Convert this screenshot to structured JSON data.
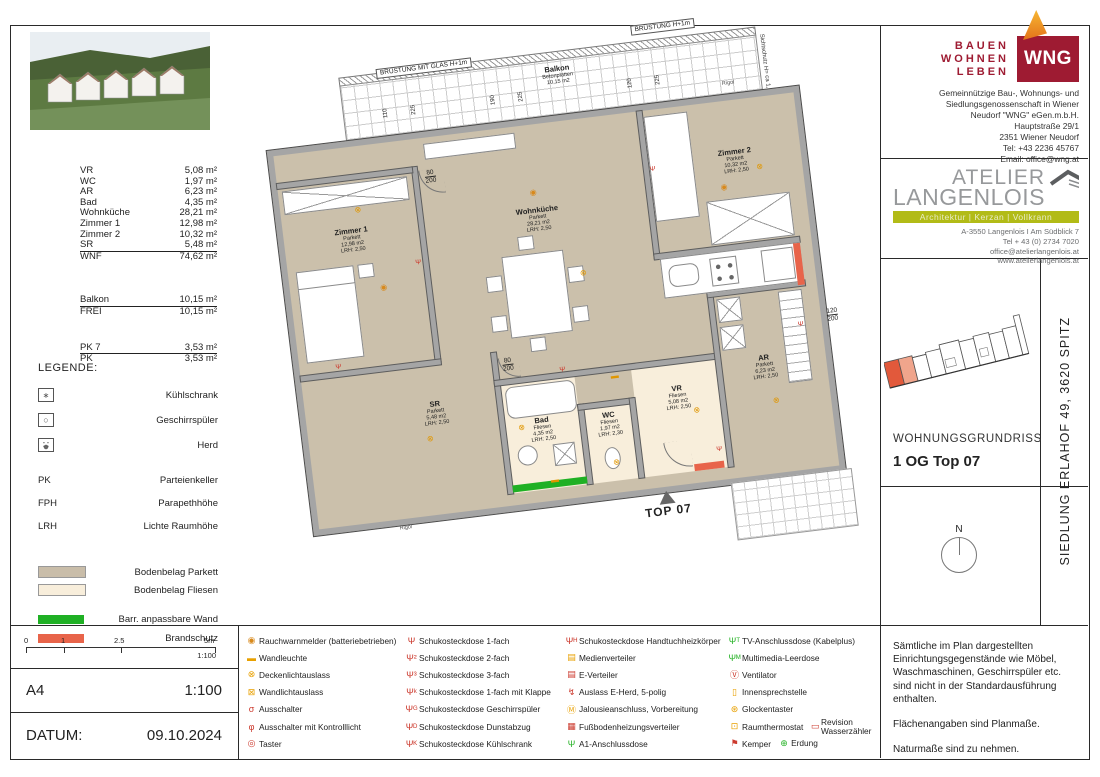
{
  "areas": {
    "rows": [
      {
        "label": "VR",
        "value": "5,08 m²",
        "cls": ""
      },
      {
        "label": "WC",
        "value": "1,97 m²",
        "cls": ""
      },
      {
        "label": "AR",
        "value": "6,23 m²",
        "cls": ""
      },
      {
        "label": "Bad",
        "value": "4,35 m²",
        "cls": ""
      },
      {
        "label": "Wohnküche",
        "value": "28,21 m²",
        "cls": ""
      },
      {
        "label": "Zimmer 1",
        "value": "12,98 m²",
        "cls": ""
      },
      {
        "label": "Zimmer 2",
        "value": "10,32 m²",
        "cls": ""
      },
      {
        "label": "SR",
        "value": "5,48 m²",
        "cls": "ruled"
      },
      {
        "label": "WNF",
        "value": "74,62 m²",
        "cls": ""
      },
      {
        "label": "Balkon",
        "value": "10,15 m²",
        "cls": "gap1 ruled"
      },
      {
        "label": "FREI",
        "value": "10,15 m²",
        "cls": ""
      },
      {
        "label": "PK 7",
        "value": "3,53 m²",
        "cls": "gap2 ruled"
      },
      {
        "label": "PK",
        "value": "3,53 m²",
        "cls": ""
      }
    ]
  },
  "legend": {
    "title": "LEGENDE:",
    "appliances": [
      {
        "icon": "fridge",
        "label": "Kühlschrank"
      },
      {
        "icon": "dishwasher",
        "label": "Geschirrspüler"
      },
      {
        "icon": "stove",
        "label": "Herd"
      }
    ],
    "abbrs": [
      {
        "abbr": "PK",
        "label": "Parteienkeller"
      },
      {
        "abbr": "FPH",
        "label": "Parapethhöhe"
      },
      {
        "abbr": "LRH",
        "label": "Lichte Raumhöhe"
      }
    ],
    "floors": [
      {
        "color": "#c9bda9",
        "label": "Bodenbelag Parkett"
      },
      {
        "color": "#f8eedb",
        "label": "Bodenbelag Fliesen"
      }
    ],
    "bars": [
      {
        "color": "#1fb024",
        "label": "Barr. anpassbare Wand"
      },
      {
        "color": "#e8644a",
        "label": "Brandschutz"
      }
    ]
  },
  "scalebar": {
    "ticks": [
      "0",
      "1",
      "2.5",
      "5m"
    ],
    "ratio": "1:100"
  },
  "format_row": {
    "format": "A4",
    "scale": "1:100"
  },
  "date_row": {
    "label": "DATUM:",
    "value": "09.10.2024"
  },
  "symbol_legend": {
    "col1": [
      {
        "g": "◉",
        "c": "#d8891c",
        "label": "Rauchwarnmelder (batteriebetrieben)"
      },
      {
        "g": "▬",
        "c": "#e8a000",
        "label": "Wandleuchte"
      },
      {
        "g": "⊗",
        "c": "#e8a000",
        "label": "Deckenlichtauslass"
      },
      {
        "g": "⊠",
        "c": "#e8a000",
        "label": "Wandlichtauslass"
      },
      {
        "g": "σ",
        "c": "#cc3a2e",
        "label": "Ausschalter"
      },
      {
        "g": "φ",
        "c": "#cc3a2e",
        "label": "Ausschalter mit Kontrolllicht"
      },
      {
        "g": "◎",
        "c": "#cc3a2e",
        "label": "Taster"
      }
    ],
    "col2": [
      {
        "g": "Ψ",
        "c": "#cc3a2e",
        "label": "Schukosteckdose 1-fach"
      },
      {
        "g": "Ψ²",
        "c": "#cc3a2e",
        "label": "Schukosteckdose 2-fach"
      },
      {
        "g": "Ψ³",
        "c": "#cc3a2e",
        "label": "Schukosteckdose 3-fach"
      },
      {
        "g": "Ψᵏ",
        "c": "#cc3a2e",
        "label": "Schukosteckdose 1-fach mit Klappe"
      },
      {
        "g": "Ψᴳ",
        "c": "#cc3a2e",
        "label": "Schukosteckdose Geschirrspüler"
      },
      {
        "g": "Ψᴰ",
        "c": "#cc3a2e",
        "label": "Schukosteckdose Dunstabzug"
      },
      {
        "g": "Ψᴷ",
        "c": "#cc3a2e",
        "label": "Schukosteckdose Kühlschrank"
      }
    ],
    "col3": [
      {
        "g": "Ψᴴ",
        "c": "#cc3a2e",
        "label": "Schukosteckdose Handtuchheizkörper"
      },
      {
        "g": "▤",
        "c": "#e8a000",
        "label": "Medienverteiler"
      },
      {
        "g": "▤",
        "c": "#cc3a2e",
        "label": "E-Verteiler"
      },
      {
        "g": "↯",
        "c": "#cc3a2e",
        "label": "Auslass E-Herd, 5-polig"
      },
      {
        "g": "Ⓜ",
        "c": "#e8a000",
        "label": "Jalousieanschluss, Vorbereitung"
      },
      {
        "g": "▦",
        "c": "#cc3a2e",
        "label": "Fußbodenheizungsverteiler"
      },
      {
        "g": "Ψ",
        "c": "#2ab42a",
        "label": "A1-Anschlussdose"
      }
    ],
    "col4": [
      {
        "g": "Ψᵀ",
        "c": "#2ab42a",
        "label": "TV-Anschlussdose (Kabelplus)"
      },
      {
        "g": "Ψᴹ",
        "c": "#2ab42a",
        "label": "Multimedia-Leerdose"
      },
      {
        "g": "Ⓥ",
        "c": "#cc3a2e",
        "label": "Ventilator"
      },
      {
        "g": "▯",
        "c": "#e8a000",
        "label": "Innensprechstelle"
      },
      {
        "g": "⊛",
        "c": "#e8a000",
        "label": "Glockentaster"
      },
      {
        "g": "⊡",
        "c": "#e8a000",
        "label": "Raumthermostat",
        "g2": "▭",
        "c2": "#cc3a2e",
        "label2": "Revision Wasserzähler"
      },
      {
        "g": "⚑",
        "c": "#cc3a2e",
        "label": "Kemper",
        "g2": "⊕",
        "c2": "#2ab42a",
        "label2": "Erdung"
      }
    ]
  },
  "wng": {
    "brand": [
      "BAUEN",
      "WOHNEN",
      "LEBEN"
    ],
    "logo": "WNG",
    "address": [
      "Gemeinnützige Bau-, Wohnungs- und",
      "Siedlungsgenossenschaft in Wiener",
      "Neudorf \"WNG\" eGen.m.b.H.",
      "Hauptstraße 29/1",
      "2351 Wiener Neudorf",
      "Tel:   +43 2236 45767",
      "Email:   office@wng.at"
    ]
  },
  "atelier": {
    "name1": "ATELIER",
    "name2": "LANGENLOIS",
    "banner": "Architektur  |  Kerzan  |  Vollkrann",
    "lines": [
      "A-3550 Langenlois  I Am Südblick 7",
      "Tel  + 43 (0) 2734 7020",
      "office@atelierlangenlois.at",
      "www.atelierlangenlois.at"
    ]
  },
  "project": {
    "plan_type": "WOHNUNGSGRUNDRISS",
    "unit": "1 OG Top 07",
    "location_vertical": "SIEDLUNG ERLAHOF 49, 3620 SPITZ",
    "north": "N"
  },
  "notes": [
    "Sämtliche im Plan dargestellten Einrichtungsgegenstände wie Möbel, Waschmaschinen, Geschirrspüler etc. sind nicht in der Standardausführung enthalten.",
    "Flächenangaben sind Planmaße.",
    "Naturmaße sind zu nehmen."
  ],
  "plan": {
    "rooms": {
      "balkon": {
        "name": "Balkon",
        "floor": "Betonplatten",
        "area": "10,15 m2"
      },
      "wohnkueche": {
        "name": "Wohnküche",
        "floor": "Parkett",
        "area": "28,21 m2",
        "lrh": "LRH: 2,50"
      },
      "zimmer1": {
        "name": "Zimmer 1",
        "floor": "Parkett",
        "area": "12,98 m2",
        "lrh": "LRH: 2,50"
      },
      "zimmer2": {
        "name": "Zimmer 2",
        "floor": "Parkett",
        "area": "10,32 m2",
        "lrh": "LRH: 2,50"
      },
      "sr": {
        "name": "SR",
        "floor": "Parkett",
        "area": "5,48 m2",
        "lrh": "LRH: 2,50"
      },
      "bad": {
        "name": "Bad",
        "floor": "Fliesen",
        "area": "4,35 m2",
        "lrh": "LRH: 2,50"
      },
      "wc": {
        "name": "WC",
        "floor": "Fliesen",
        "area": "1,97 m2",
        "lrh": "LRH: 2,30"
      },
      "vr": {
        "name": "VR",
        "floor": "Fliesen",
        "area": "5,08 m2",
        "lrh": "LRH: 2,50"
      },
      "ar": {
        "name": "AR",
        "floor": "Parkett",
        "area": "6,23 m2",
        "lrh": "LRH: 2,50"
      }
    },
    "texts": {
      "bruestung_glas": "BRÜSTUNG MIT GLAS H+1m",
      "bruestung": "BRÜSTUNG H+1m",
      "sichtschutz": "Sichtschutz H= ca 1,80m",
      "rigol": "Rigol",
      "top": "TOP 07"
    },
    "dims": [
      "110",
      "225",
      "190",
      "225",
      "120",
      "225"
    ],
    "door_dim": {
      "w": "80",
      "h": "200"
    },
    "right_dim": {
      "w": "120",
      "h": "200"
    }
  }
}
